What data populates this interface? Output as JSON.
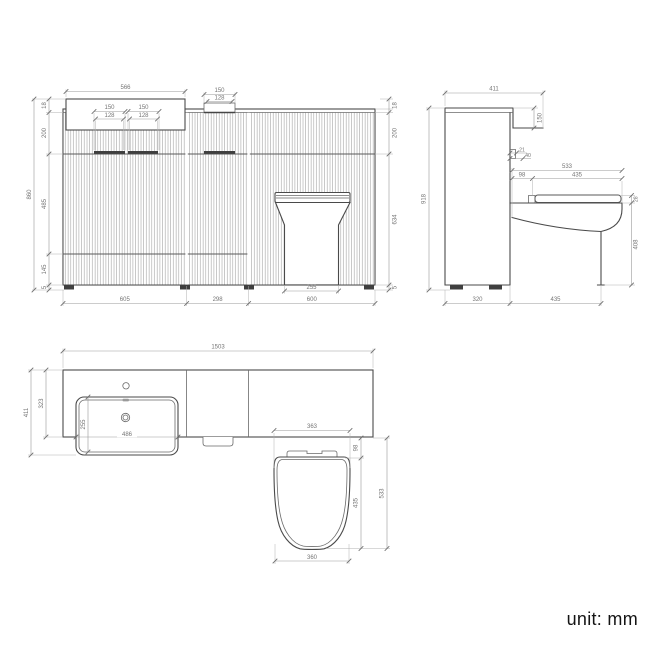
{
  "unit_note": "unit: mm",
  "front": {
    "basin_width": "566",
    "recess_outer": "150",
    "recess_inner": "128",
    "handle_a_outer": "150",
    "handle_a_inner": "128",
    "handle_b_outer": "150",
    "handle_b_inner": "128",
    "counter_thickness": "18",
    "drawer_height": "200",
    "mid_height": "485",
    "lower_height": "145",
    "plinth": "5",
    "overall_height": "860",
    "r_counter_thickness": "18",
    "r_drawer_height": "200",
    "r_body_height": "634",
    "r_plinth": "5",
    "pedestal_width": "255",
    "vanity_width": "605",
    "mid_width": "298",
    "wc_width": "600"
  },
  "side": {
    "top_depth": "411",
    "fascia_drop": "150",
    "gap": "21",
    "bracket": "40",
    "pan_overall": "533",
    "setback": "98",
    "pan_run": "435",
    "seat_thickness": "28",
    "pan_height": "408",
    "overall_height": "918",
    "base_depth": "320",
    "projection": "435"
  },
  "plan": {
    "overall_width": "1503",
    "overall_depth": "411",
    "counter_depth": "323",
    "basin_depth": "255",
    "basin_width": "486",
    "seat_width": "363",
    "setback": "98",
    "seat_depth": "435",
    "pan_overall": "533",
    "seat_bottom_width": "360"
  }
}
